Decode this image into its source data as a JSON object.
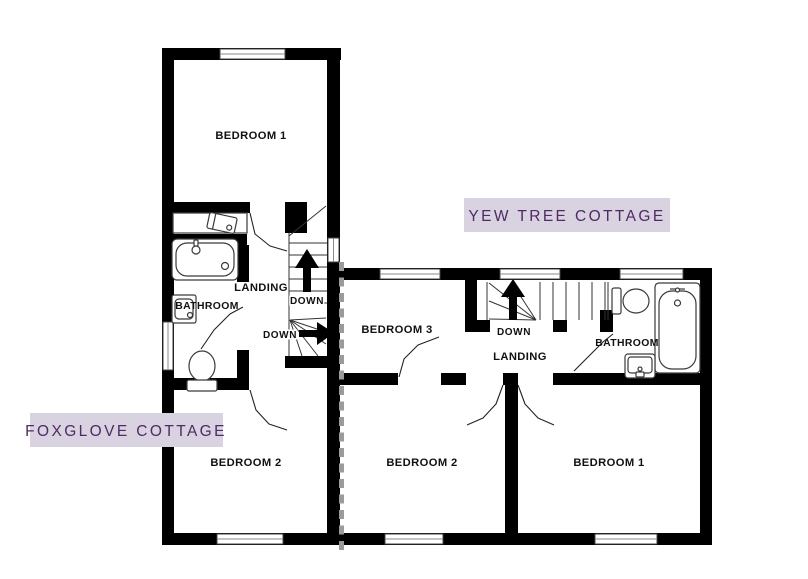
{
  "plan": {
    "foxglove": {
      "badge": "FOXGLOVE COTTAGE",
      "rooms": {
        "bedroom1": "BEDROOM 1",
        "bedroom2": "BEDROOM 2",
        "bathroom": "BATHROOM",
        "landing": "LANDING"
      },
      "stairs": {
        "down_upper": "DOWN",
        "down_lower": "DOWN"
      }
    },
    "yewtree": {
      "badge": "YEW TREE COTTAGE",
      "rooms": {
        "bedroom1": "BEDROOM 1",
        "bedroom2": "BEDROOM 2",
        "bedroom3": "BEDROOM 3",
        "bathroom": "BATHROOM",
        "landing": "LANDING"
      },
      "stairs": {
        "down": "DOWN"
      }
    },
    "colors": {
      "wall": "#000000",
      "badge_background": "#d9d2e1",
      "badge_text": "#4f2a63",
      "boundary_dash": "#9b9b9b",
      "fixture_stroke": "#3a3a3a",
      "window_line": "#8a8a8a"
    }
  }
}
